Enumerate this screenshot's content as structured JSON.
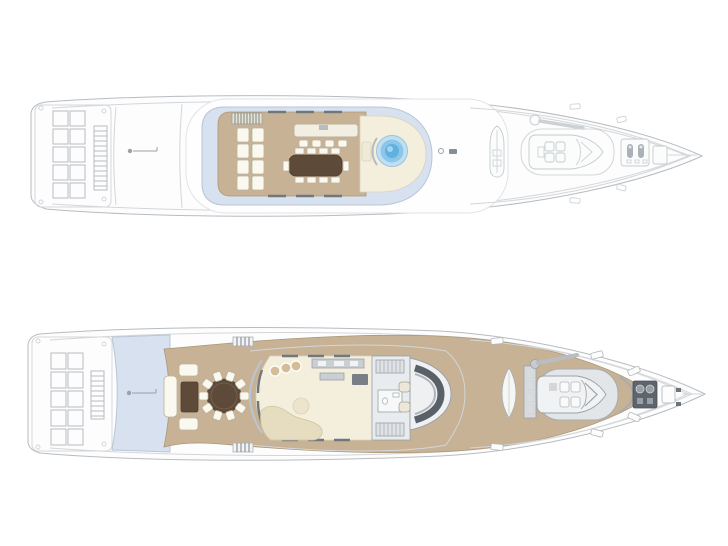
{
  "colors": {
    "background": "#ffffff",
    "hull_fill": "#fdfdfe",
    "line_faint": "#d3d6d9",
    "line_mid": "#b7bcc1",
    "line_dark": "#99a1a8",
    "teak": "#c8b295",
    "teak_edge": "#ab9778",
    "cream": "#f4efdd",
    "shadow_blue": "#d7e1ef",
    "glass_stroke": "#b9c6d6",
    "pool_outer": "#bfe0f2",
    "pool_mid": "#8cc6e9",
    "pool_core": "#60b0e0",
    "table_brown": "#5e4a39",
    "table_brown_edge": "#4e3e30",
    "sofa_beige": "#e6dcc0",
    "furniture_white": "#faf8ef",
    "furniture_edge": "#b9b29e",
    "equip_gray": "#c9cfd3",
    "equip_dark": "#5d646b",
    "console_dark": "#596067",
    "wicker_tan": "#d3bd97"
  },
  "plans": {
    "sun_deck": {
      "elements": {
        "open_aft_loungers": 10,
        "aft_ladder": 1,
        "flag_staff": 1,
        "stair_hatch": 1,
        "sun_loungers": 8,
        "bar_counter": 1,
        "bar_stools": 4,
        "dining_table_seats": 10,
        "jacuzzi_pool": 1,
        "deck_fittings": 2,
        "foredeck_small_boat": 1,
        "foredeck_crane": 1,
        "foredeck_tender": 1,
        "anchor_windlass": 1
      }
    },
    "main_deck": {
      "elements": {
        "beach_loungers": 10,
        "aft_ladder": 1,
        "flag_staff": 1,
        "shaded_overhang": 1,
        "aft_sofa_set": 1,
        "coffee_table": 1,
        "round_dining_seats": 10,
        "salon": 1,
        "lounge_poufs": 3,
        "curved_sofa": 1,
        "galley_counter": 1,
        "stairs": 2,
        "wc": 1,
        "wheelhouse_console": 1,
        "helm_chairs": 2,
        "kayak": 1,
        "deck_lockers": 1,
        "crane": 1,
        "tender": 1,
        "anchor_windlass": 1
      }
    }
  }
}
